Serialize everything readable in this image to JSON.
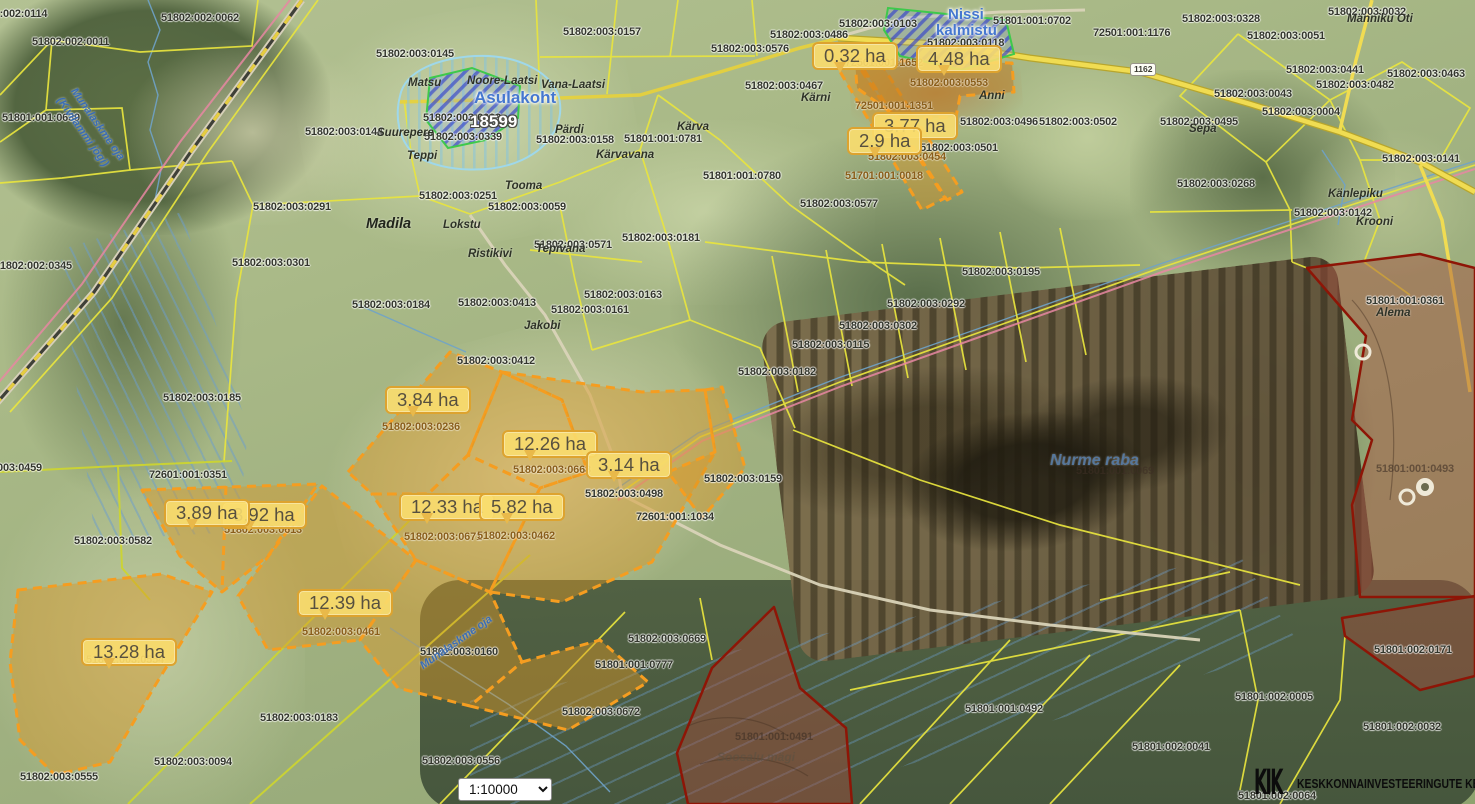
{
  "ui": {
    "scale": {
      "value": "1:10000"
    },
    "watermark": {
      "text": "KESKKONNAINVESTEERINGUTE KESKUS",
      "icon": "kik-logo",
      "glyph": "KIK"
    },
    "road_badge": "1162"
  },
  "colors": {
    "parcel_boundary": "#e9e53e",
    "selected_fill": "rgba(217,150,38,0.45)",
    "selected_border": "#f59d20",
    "restricted_fill": "rgba(165,75,60,0.45)",
    "restricted_border": "#8e1506",
    "heritage_border": "#3ec94b",
    "heritage_hatch": "#2d3ccd",
    "callout_bg": "#fadd6e",
    "callout_border": "#dda32f"
  },
  "area_callouts": [
    {
      "t": "0.32 ha",
      "x": 812,
      "y": 42
    },
    {
      "t": "4.48 ha",
      "x": 916,
      "y": 45
    },
    {
      "t": "3.77 ha",
      "x": 872,
      "y": 112
    },
    {
      "t": "2.9 ha",
      "x": 847,
      "y": 127
    },
    {
      "t": "3.84 ha",
      "x": 385,
      "y": 386
    },
    {
      "t": "12.26 ha",
      "x": 502,
      "y": 430
    },
    {
      "t": "3.14 ha",
      "x": 586,
      "y": 451
    },
    {
      "t": "12.33 ha",
      "x": 399,
      "y": 493
    },
    {
      "t": "5.82 ha",
      "x": 479,
      "y": 493
    },
    {
      "t": "3.92 ha",
      "x": 221,
      "y": 501
    },
    {
      "t": "3.89 ha",
      "x": 164,
      "y": 499
    },
    {
      "t": "12.39 ha",
      "x": 297,
      "y": 589
    },
    {
      "t": "13.28 ha",
      "x": 81,
      "y": 638
    }
  ],
  "parcel_codes": [
    {
      "t": "51802:002:0114",
      "x": -30,
      "y": 8,
      "v": "d"
    },
    {
      "t": "51802:002:0062",
      "x": 161,
      "y": 12,
      "v": "d"
    },
    {
      "t": "51802:002:0011",
      "x": 32,
      "y": 36,
      "v": "d"
    },
    {
      "t": "51801:001:0639",
      "x": 2,
      "y": 112,
      "v": "d"
    },
    {
      "t": "51802:003:0145",
      "x": 376,
      "y": 48,
      "v": "d"
    },
    {
      "t": "51802:003:0157",
      "x": 563,
      "y": 26,
      "v": "d"
    },
    {
      "t": "51802:003:0144",
      "x": 305,
      "y": 126,
      "v": "d"
    },
    {
      "t": "51802:003:0291",
      "x": 253,
      "y": 201,
      "v": "d"
    },
    {
      "t": "51802:002:0345",
      "x": -6,
      "y": 260,
      "v": "d"
    },
    {
      "t": "51802:003:0301",
      "x": 232,
      "y": 257,
      "v": "d"
    },
    {
      "t": "51802:003:0185",
      "x": 163,
      "y": 392,
      "v": "d"
    },
    {
      "t": "51802:003:0184",
      "x": 352,
      "y": 299,
      "v": "d"
    },
    {
      "t": "51802:003:0059",
      "x": 488,
      "y": 201,
      "v": "d"
    },
    {
      "t": "51802:003:0251",
      "x": 419,
      "y": 190,
      "v": "d"
    },
    {
      "t": "51802:003:0571",
      "x": 534,
      "y": 239,
      "v": "d"
    },
    {
      "t": "51802:003:0181",
      "x": 622,
      "y": 232,
      "v": "d"
    },
    {
      "t": "51802:003:0163",
      "x": 584,
      "y": 289,
      "v": "d"
    },
    {
      "t": "51802:003:0161",
      "x": 551,
      "y": 304,
      "v": "d"
    },
    {
      "t": "51802:003:0413",
      "x": 458,
      "y": 297,
      "v": "d"
    },
    {
      "t": "51802:003:0412",
      "x": 457,
      "y": 355,
      "v": "d"
    },
    {
      "t": "51802:003:0158",
      "x": 536,
      "y": 134,
      "v": "d"
    },
    {
      "t": "51801:001:0781",
      "x": 624,
      "y": 133,
      "v": "d"
    },
    {
      "t": "51801:001:0780",
      "x": 703,
      "y": 170,
      "v": "d"
    },
    {
      "t": "51802:003:0576",
      "x": 711,
      "y": 43,
      "v": "d"
    },
    {
      "t": "51802:003:0577",
      "x": 800,
      "y": 198,
      "v": "d"
    },
    {
      "t": "51802:003:0093",
      "x": 423,
      "y": 112,
      "v": "d"
    },
    {
      "t": "51802:003:0339",
      "x": 424,
      "y": 131,
      "v": "d"
    },
    {
      "t": "51801:001:0702",
      "x": 993,
      "y": 15,
      "v": "d"
    },
    {
      "t": "51802:003:0103",
      "x": 839,
      "y": 18,
      "v": "d"
    },
    {
      "t": "51802:003:0486",
      "x": 770,
      "y": 29,
      "v": "d"
    },
    {
      "t": "51802:003:0467",
      "x": 745,
      "y": 80,
      "v": "d"
    },
    {
      "t": "72501:001:1176",
      "x": 1093,
      "y": 27,
      "v": "d"
    },
    {
      "t": "51802:003:0328",
      "x": 1182,
      "y": 13,
      "v": "d"
    },
    {
      "t": "51802:003:0032",
      "x": 1328,
      "y": 6,
      "v": "d"
    },
    {
      "t": "51802:003:0051",
      "x": 1247,
      "y": 30,
      "v": "d"
    },
    {
      "t": "51802:003:0043",
      "x": 1214,
      "y": 88,
      "v": "d"
    },
    {
      "t": "51802:003:0441",
      "x": 1286,
      "y": 64,
      "v": "d"
    },
    {
      "t": "51802:003:0482",
      "x": 1316,
      "y": 79,
      "v": "d"
    },
    {
      "t": "51802:003:0463",
      "x": 1387,
      "y": 68,
      "v": "d"
    },
    {
      "t": "51802:003:0004",
      "x": 1262,
      "y": 106,
      "v": "d"
    },
    {
      "t": "51802:003:0495",
      "x": 1160,
      "y": 116,
      "v": "d"
    },
    {
      "t": "51802:003:0141",
      "x": 1382,
      "y": 153,
      "v": "d"
    },
    {
      "t": "51802:003:0268",
      "x": 1177,
      "y": 178,
      "v": "d"
    },
    {
      "t": "51802:003:0142",
      "x": 1294,
      "y": 207,
      "v": "d"
    },
    {
      "t": "51802:003:0502",
      "x": 1039,
      "y": 116,
      "v": "d"
    },
    {
      "t": "51802:003:0496",
      "x": 960,
      "y": 116,
      "v": "d"
    },
    {
      "t": "51802:003:0501",
      "x": 920,
      "y": 142,
      "v": "d"
    },
    {
      "t": "51802:003:0553",
      "x": 910,
      "y": 77,
      "v": "b"
    },
    {
      "t": "72501:001:1652",
      "x": 845,
      "y": 57,
      "v": "b"
    },
    {
      "t": "72501:001:1351",
      "x": 855,
      "y": 100,
      "v": "b"
    },
    {
      "t": "51802:003:0454",
      "x": 868,
      "y": 151,
      "v": "b"
    },
    {
      "t": "51701:001:0018",
      "x": 845,
      "y": 170,
      "v": "b"
    },
    {
      "t": "51802:003:0118",
      "x": 927,
      "y": 37,
      "v": "d"
    },
    {
      "t": "51802:003:0195",
      "x": 962,
      "y": 266,
      "v": "d"
    },
    {
      "t": "51802:003:0292",
      "x": 887,
      "y": 298,
      "v": "d"
    },
    {
      "t": "51802:003:0302",
      "x": 839,
      "y": 320,
      "v": "d"
    },
    {
      "t": "51802:003:0115",
      "x": 792,
      "y": 339,
      "v": "d"
    },
    {
      "t": "51802:003:0182",
      "x": 738,
      "y": 366,
      "v": "d"
    },
    {
      "t": "51802:003:0159",
      "x": 704,
      "y": 473,
      "v": "d"
    },
    {
      "t": "51801:001:0069",
      "x": 1076,
      "y": 465,
      "v": "f"
    },
    {
      "t": "51802:003:0236",
      "x": 382,
      "y": 421,
      "v": "b"
    },
    {
      "t": "51802:003:0668",
      "x": 513,
      "y": 464,
      "v": "b"
    },
    {
      "t": "51802:003:0498",
      "x": 585,
      "y": 488,
      "v": "d"
    },
    {
      "t": "72601:001:1034",
      "x": 636,
      "y": 511,
      "v": "d"
    },
    {
      "t": "51802:003:0671",
      "x": 404,
      "y": 531,
      "v": "b"
    },
    {
      "t": "51802:003:0462",
      "x": 477,
      "y": 530,
      "v": "b"
    },
    {
      "t": "51802:003:0613",
      "x": 224,
      "y": 524,
      "v": "b"
    },
    {
      "t": "72601:001:0351",
      "x": 149,
      "y": 469,
      "v": "d"
    },
    {
      "t": "51802:003:0582",
      "x": 74,
      "y": 535,
      "v": "d"
    },
    {
      "t": "51802:003:0459",
      "x": -36,
      "y": 462,
      "v": "d"
    },
    {
      "t": "51802:003:0461",
      "x": 302,
      "y": 626,
      "v": "b"
    },
    {
      "t": "51802:003:0554",
      "x": 86,
      "y": 654,
      "v": "b"
    },
    {
      "t": "51802:003:0555",
      "x": 20,
      "y": 771,
      "v": "d"
    },
    {
      "t": "51802:003:0094",
      "x": 154,
      "y": 756,
      "v": "d"
    },
    {
      "t": "51802:003:0183",
      "x": 260,
      "y": 712,
      "v": "d"
    },
    {
      "t": "51802:003:0160",
      "x": 420,
      "y": 646,
      "v": "d"
    },
    {
      "t": "51802:003:0556",
      "x": 422,
      "y": 755,
      "v": "d"
    },
    {
      "t": "51802:003:0669",
      "x": 628,
      "y": 633,
      "v": "d"
    },
    {
      "t": "51801:001:0777",
      "x": 595,
      "y": 659,
      "v": "d"
    },
    {
      "t": "51802:003:0672",
      "x": 562,
      "y": 706,
      "v": "d"
    },
    {
      "t": "51801:001:0491",
      "x": 735,
      "y": 731,
      "v": "f"
    },
    {
      "t": "51801:001:0492",
      "x": 965,
      "y": 703,
      "v": "d"
    },
    {
      "t": "51801:002:0171",
      "x": 1374,
      "y": 644,
      "v": "d"
    },
    {
      "t": "51801:002:0005",
      "x": 1235,
      "y": 691,
      "v": "d"
    },
    {
      "t": "51801:002:0032",
      "x": 1363,
      "y": 721,
      "v": "d"
    },
    {
      "t": "51801:002:0041",
      "x": 1132,
      "y": 741,
      "v": "d"
    },
    {
      "t": "51801:002:0064",
      "x": 1238,
      "y": 790,
      "v": "d"
    },
    {
      "t": "51801:001:0493",
      "x": 1376,
      "y": 463,
      "v": "f"
    },
    {
      "t": "51801:001:0361",
      "x": 1366,
      "y": 295,
      "v": "d"
    }
  ],
  "place_names": [
    {
      "t": "Madila",
      "x": 366,
      "y": 216,
      "k": "village"
    },
    {
      "t": "Matsu",
      "x": 408,
      "y": 77,
      "k": "farm"
    },
    {
      "t": "Noore-Laatsi",
      "x": 467,
      "y": 75,
      "k": "farm"
    },
    {
      "t": "Vana-Laatsi",
      "x": 541,
      "y": 79,
      "k": "farm"
    },
    {
      "t": "Suurepere",
      "x": 377,
      "y": 127,
      "k": "farm"
    },
    {
      "t": "Teppi",
      "x": 407,
      "y": 150,
      "k": "farm"
    },
    {
      "t": "Pärdi",
      "x": 555,
      "y": 124,
      "k": "farm"
    },
    {
      "t": "Tooma",
      "x": 505,
      "y": 180,
      "k": "farm"
    },
    {
      "t": "Lokstu",
      "x": 443,
      "y": 219,
      "k": "farm"
    },
    {
      "t": "Ristikivi",
      "x": 468,
      "y": 248,
      "k": "farm"
    },
    {
      "t": "Tepivana",
      "x": 536,
      "y": 243,
      "k": "farm"
    },
    {
      "t": "Jakobi",
      "x": 524,
      "y": 320,
      "k": "farm"
    },
    {
      "t": "Kärva",
      "x": 677,
      "y": 121,
      "k": "farm"
    },
    {
      "t": "Kärvavana",
      "x": 596,
      "y": 149,
      "k": "farm"
    },
    {
      "t": "Anni",
      "x": 979,
      "y": 90,
      "k": "farm"
    },
    {
      "t": "Kärni",
      "x": 801,
      "y": 92,
      "k": "farm"
    },
    {
      "t": "Sepa",
      "x": 1189,
      "y": 123,
      "k": "farm"
    },
    {
      "t": "Männiku Oti",
      "x": 1347,
      "y": 13,
      "k": "farm"
    },
    {
      "t": "Känlepiku",
      "x": 1328,
      "y": 188,
      "k": "farm"
    },
    {
      "t": "Krooni",
      "x": 1356,
      "y": 216,
      "k": "farm"
    },
    {
      "t": "Alema",
      "x": 1376,
      "y": 307,
      "k": "farm"
    },
    {
      "t": "Soosalu mägi",
      "x": 717,
      "y": 750,
      "k": "faint"
    },
    {
      "t": "Nurme raba",
      "x": 1050,
      "y": 452,
      "k": "water-lg"
    },
    {
      "t": "Asulakoht",
      "x": 474,
      "y": 88,
      "k": "site-lg"
    },
    {
      "t": "Nissi",
      "x": 948,
      "y": 6,
      "k": "site"
    },
    {
      "t": "kalmistu",
      "x": 936,
      "y": 22,
      "k": "site"
    },
    {
      "t": "18599",
      "x": 470,
      "y": 112,
      "k": "siteid"
    },
    {
      "t": "Munalaskme oja",
      "x": 78,
      "y": 86,
      "k": "water",
      "r": 55
    },
    {
      "t": "(Kivilammi jõgi)",
      "x": 64,
      "y": 95,
      "k": "water",
      "r": 55
    },
    {
      "t": "Munalaskme oja",
      "x": 418,
      "y": 662,
      "k": "water",
      "r": -35
    }
  ]
}
